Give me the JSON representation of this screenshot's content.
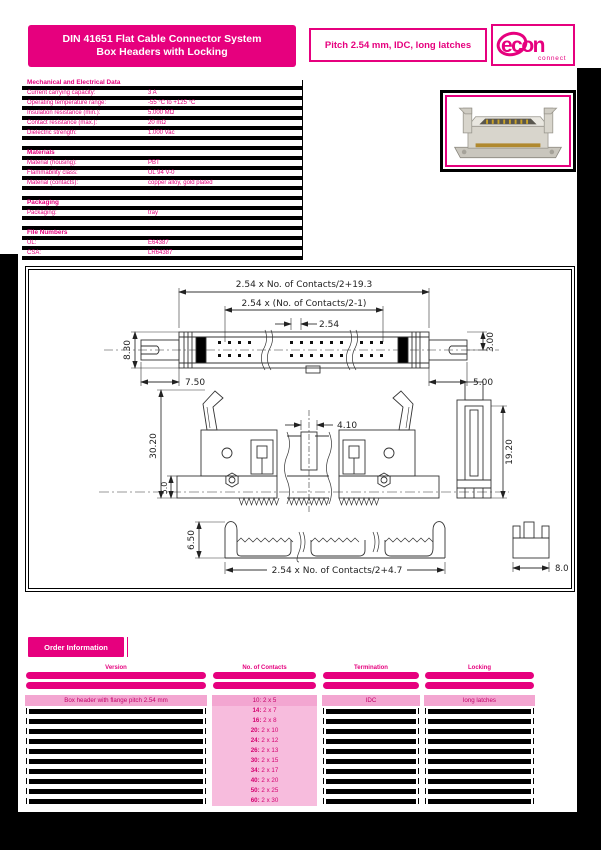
{
  "header": {
    "title_line1": "DIN 41651 Flat Cable Connector System",
    "title_line2": "Box Headers with Locking",
    "pitch_info": "Pitch 2.54 mm, IDC, long latches",
    "logo_text": "econ",
    "logo_subtext": "connect"
  },
  "specs": {
    "sections": [
      {
        "title": "Mechanical and Electrical Data",
        "rows": [
          {
            "label": "Current carrying capacity:",
            "value": "3 A"
          },
          {
            "label": "Operating temperature range:",
            "value": "-55 °C to +125 °C"
          },
          {
            "label": "Insulation resistance (min.):",
            "value": "5.000 MΩ"
          },
          {
            "label": "Contact resistance (max.):",
            "value": "20 mΩ"
          },
          {
            "label": "Dielectric strength:",
            "value": "1.000 Vac"
          }
        ]
      },
      {
        "title": "Materials",
        "rows": [
          {
            "label": "Material (housing):",
            "value": "PBT"
          },
          {
            "label": "Flammability class:",
            "value": "UL 94 V-0"
          },
          {
            "label": "Material (contacts):",
            "value": "copper alloy, gold plated"
          }
        ]
      },
      {
        "title": "Packaging",
        "rows": [
          {
            "label": "Packaging:",
            "value": "tray"
          }
        ]
      },
      {
        "title": "File Numbers",
        "rows": [
          {
            "label": "UL:",
            "value": "E64387"
          },
          {
            "label": "CSA:",
            "value": "LR64387"
          }
        ]
      }
    ]
  },
  "drawing": {
    "top_view": {
      "overall_width": "2.54 x No. of Contacts/2+19.3",
      "contact_span": "2.54 x (No. of Contacts/2-1)",
      "pitch": "2.54",
      "body_height": "8.30",
      "right_height": "3.00",
      "left_offset": "7.50",
      "right_offset": "5.00"
    },
    "front_view": {
      "total_height": "30.20",
      "base_height": "5.0",
      "slot_width": "4.10",
      "side_height": "19.20"
    },
    "bottom_view": {
      "strain_relief_height": "6.50",
      "strain_relief_width": "2.54 x No. of Contacts/2+4.7",
      "side_width": "8.0"
    }
  },
  "order": {
    "badge": "Order Information",
    "columns": [
      "Version",
      "No. of Contacts",
      "Termination",
      "Locking"
    ],
    "first_row": {
      "version": "Box header with flange pitch 2.54 mm",
      "contacts_num": "10:",
      "contacts_grid": "2 x 5",
      "termination": "IDC",
      "locking": "long latches"
    },
    "contact_rows": [
      {
        "num": "14:",
        "grid": "2 x 7"
      },
      {
        "num": "16:",
        "grid": "2 x 8"
      },
      {
        "num": "20:",
        "grid": "2 x 10"
      },
      {
        "num": "24:",
        "grid": "2 x 12"
      },
      {
        "num": "26:",
        "grid": "2 x 13"
      },
      {
        "num": "30:",
        "grid": "2 x 15"
      },
      {
        "num": "34:",
        "grid": "2 x 17"
      },
      {
        "num": "40:",
        "grid": "2 x 20"
      },
      {
        "num": "50:",
        "grid": "2 x 25"
      },
      {
        "num": "60:",
        "grid": "2 x 30"
      }
    ]
  }
}
